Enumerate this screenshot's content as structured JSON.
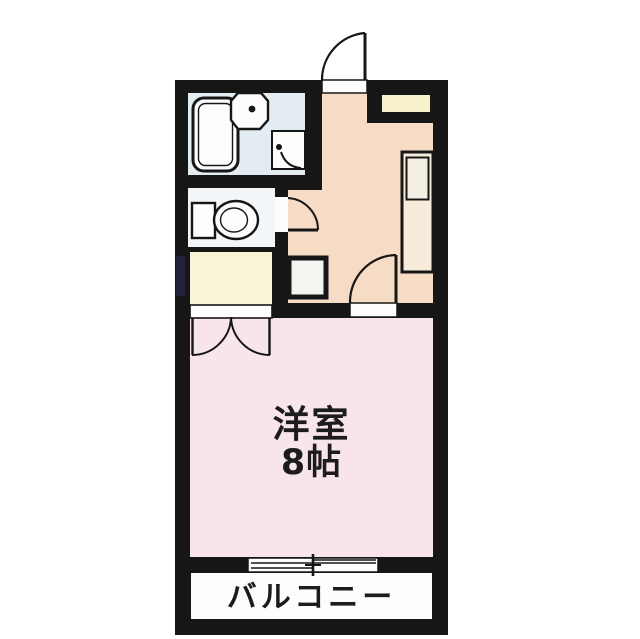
{
  "floorplan": {
    "main_room": {
      "label_line1": "洋室",
      "label_line2": "8帖"
    },
    "balcony": {
      "label": "バルコニー"
    },
    "rooms": [
      {
        "name": "bathroom"
      },
      {
        "name": "toilet-room"
      },
      {
        "name": "closet"
      },
      {
        "name": "kitchen-dining"
      },
      {
        "name": "main-room-8jo"
      },
      {
        "name": "balcony"
      },
      {
        "name": "shoe-cabinet"
      }
    ],
    "fixtures": [
      "bathtub",
      "wash-basin",
      "toilet",
      "kitchen-counter-with-sink",
      "washing-machine-space",
      "entrance-door-swing",
      "bathroom-door-swing",
      "toilet-door-swing",
      "main-room-door-swing",
      "closet-double-doors",
      "balcony-sliding-window"
    ]
  },
  "colors": {
    "page": "#ffffff",
    "wall": "#161616",
    "fixture": "#fdfdfd",
    "bathroom": "#e3edf1",
    "toilet_room": "#f3f6f8",
    "closet": "#faf4d6",
    "kitchen": "#f6dbc5",
    "main_room": "#f8e4ec",
    "balcony": "#fdfdfd",
    "shoe_cabinet": "#f8f2cc",
    "counter": "#f7ecdc",
    "sink": "#f3f0e3",
    "appliance": "#f2f5f0",
    "label": "#1c1c1c",
    "artifact": "#2e2e5e"
  }
}
